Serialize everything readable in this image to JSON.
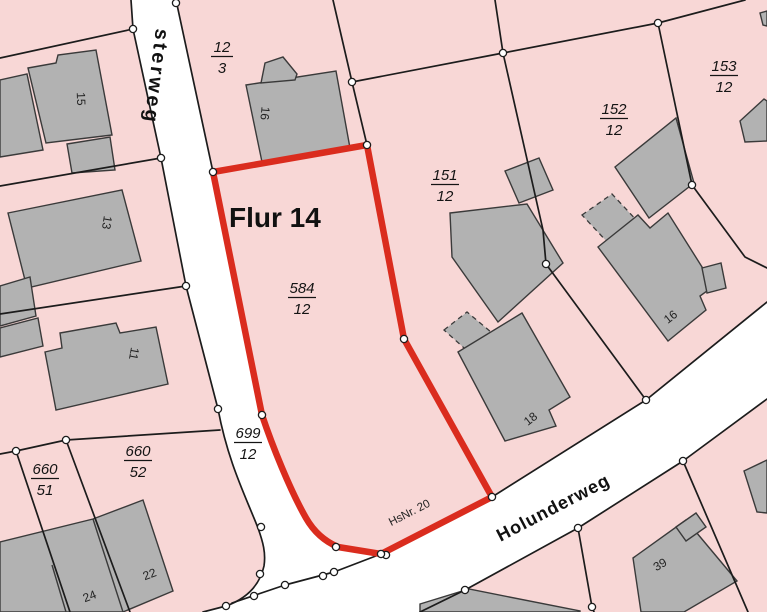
{
  "map": {
    "flur_label": "Flur 14",
    "street_vertical": "sterweg",
    "street_main": "Holunderweg",
    "house_number_note": "HsNr. 20",
    "parcels": {
      "p12_3": {
        "num": "12",
        "den": "3"
      },
      "p584_12": {
        "num": "584",
        "den": "12"
      },
      "p151_12": {
        "num": "151",
        "den": "12"
      },
      "p152_12": {
        "num": "152",
        "den": "12"
      },
      "p153_12": {
        "num": "153",
        "den": "12"
      },
      "p699_12": {
        "num": "699",
        "den": "12"
      },
      "p660_52": {
        "num": "660",
        "den": "52"
      },
      "p660_51": {
        "num": "660",
        "den": "51"
      }
    },
    "house_numbers": {
      "b15": "15",
      "b13": "13",
      "b11": "11",
      "b16_top": "16",
      "b16_right": "16",
      "b18": "18",
      "b39": "39",
      "b22": "22",
      "b24": "24"
    },
    "colors": {
      "parcel_fill": "#f8d7d6",
      "street_fill": "#ffffff",
      "building_fill": "#b2b2b2",
      "boundary_red": "#da2c1e",
      "line": "#1c1c1c"
    }
  }
}
